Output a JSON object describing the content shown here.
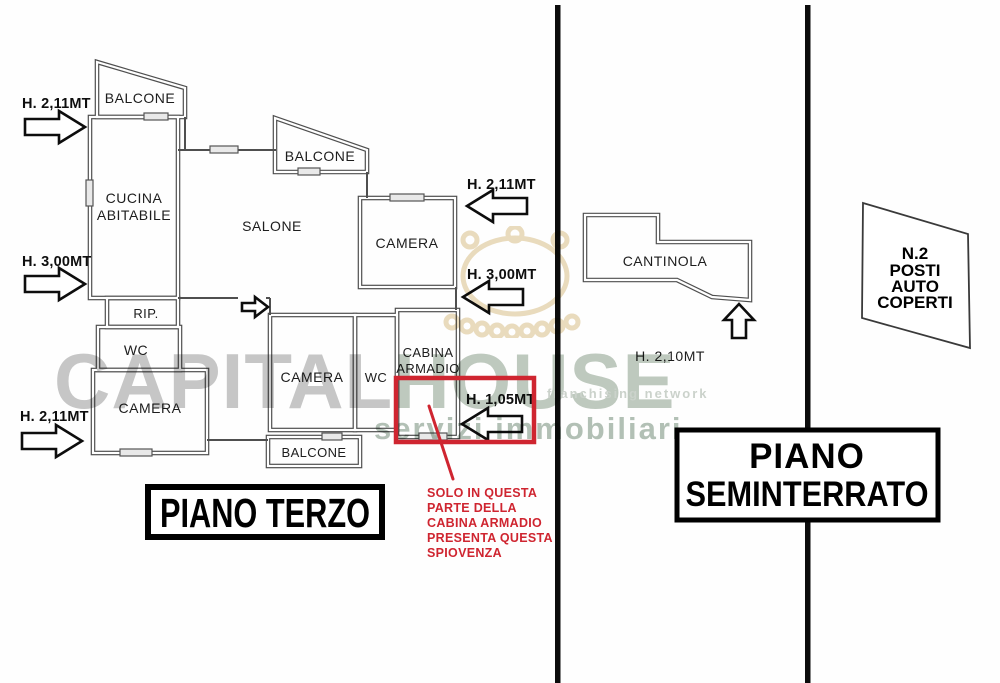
{
  "floor3": {
    "title": "PIANO TERZO",
    "rooms": {
      "balcone_top": "BALCONE",
      "cucina_l1": "CUCINA",
      "cucina_l2": "ABITABILE",
      "salone": "SALONE",
      "balcone_mid": "BALCONE",
      "camera_top": "CAMERA",
      "rip": "RIP.",
      "wc_left": "WC",
      "camera_left": "CAMERA",
      "camera_center": "CAMERA",
      "wc_center": "WC",
      "cabina_l1": "CABINA",
      "cabina_l2": "ARMADIO",
      "balcone_bottom": "BALCONE"
    },
    "heights": {
      "left_top": "H. 2,11MT",
      "left_mid": "H. 3,00MT",
      "left_bottom": "H. 2,11MT",
      "right_top": "H. 2,11MT",
      "right_mid": "H. 3,00MT",
      "spiovenza": "H. 1,05MT"
    },
    "note_lines": [
      "SOLO IN QUESTA",
      "PARTE DELLA",
      "CABINA ARMADIO",
      "PRESENTA QUESTA",
      "SPIOVENZA"
    ]
  },
  "basement": {
    "title_l1": "PIANO",
    "title_l2": "SEMINTERRATO",
    "room": "CANTINOLA",
    "height": "H. 2,10MT"
  },
  "parking": {
    "lines": [
      "N.2",
      "POSTI",
      "AUTO",
      "COPERTI"
    ]
  },
  "watermark": {
    "brand_a": "CAPITAL",
    "brand_b": "HOUSE",
    "tagline": "franchising network",
    "subtitle": "servizi immobiliari"
  },
  "colors": {
    "annotation_red": "#cf2530",
    "wall_gray": "#4f4f4f",
    "divider_black": "#0c0c0c",
    "watermark_gray": "#c7c7c7",
    "watermark_green": "#b3c1b6",
    "watermark_tan": "#e3d0a9"
  }
}
